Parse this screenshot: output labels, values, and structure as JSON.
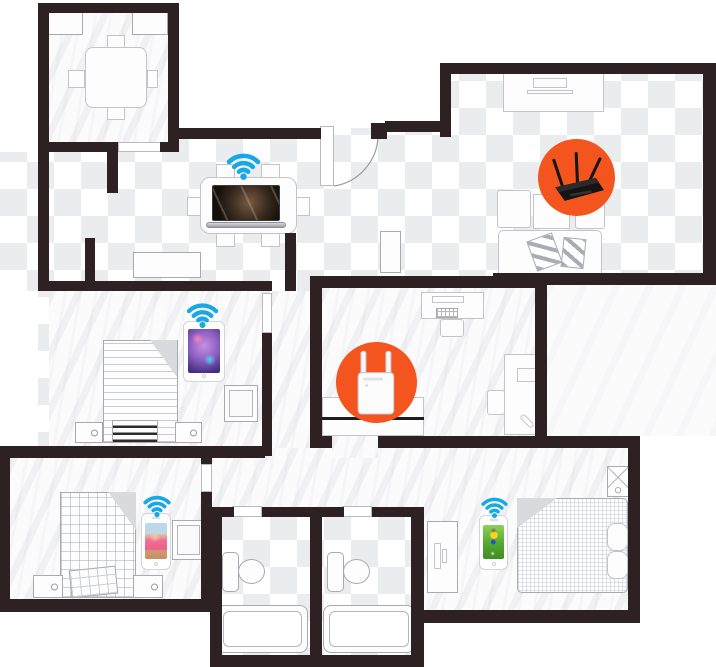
{
  "diagram": {
    "type": "apartment-floor-plan-wifi-coverage",
    "description": "Apartment floor plan showing a WiFi router, a range extender and four connected devices with WiFi signal icons"
  },
  "colors": {
    "accent_orange": "#f4541d",
    "wifi_blue": "#18a8e8",
    "wall": "#2e2123",
    "checker": "#ebecee",
    "floor": "#fbfbfc",
    "furniture_line": "#a9a9b0"
  },
  "hotspots": [
    {
      "name": "wifi-router",
      "icon": "router-icon",
      "x": 538,
      "y": 139,
      "size": 77
    },
    {
      "name": "range-extender",
      "icon": "extender-icon",
      "x": 336,
      "y": 342,
      "size": 81
    }
  ],
  "devices": [
    {
      "name": "laptop",
      "screen_content": "movie-scene",
      "x": 206,
      "y": 183,
      "w": 80,
      "h": 45
    },
    {
      "name": "tablet",
      "screen_content": "game-character-art",
      "x": 183,
      "y": 321,
      "w": 42,
      "h": 61
    },
    {
      "name": "phone-beach",
      "screen_content": "beach-photo",
      "x": 141,
      "y": 513,
      "w": 30,
      "h": 57
    },
    {
      "name": "phone-soccer",
      "screen_content": "soccer-player",
      "x": 479,
      "y": 515,
      "w": 29,
      "h": 55
    }
  ],
  "wifi_signals": [
    {
      "name": "wifi-signal-living-room",
      "x": 221,
      "y": 149,
      "w": 45,
      "h": 32
    },
    {
      "name": "wifi-signal-left-bedroom",
      "x": 181,
      "y": 299,
      "w": 43,
      "h": 30
    },
    {
      "name": "wifi-signal-bottom-left-bedroom",
      "x": 139,
      "y": 492,
      "w": 36,
      "h": 26
    },
    {
      "name": "wifi-signal-bottom-right-bedroom",
      "x": 477,
      "y": 494,
      "w": 35,
      "h": 25
    }
  ]
}
